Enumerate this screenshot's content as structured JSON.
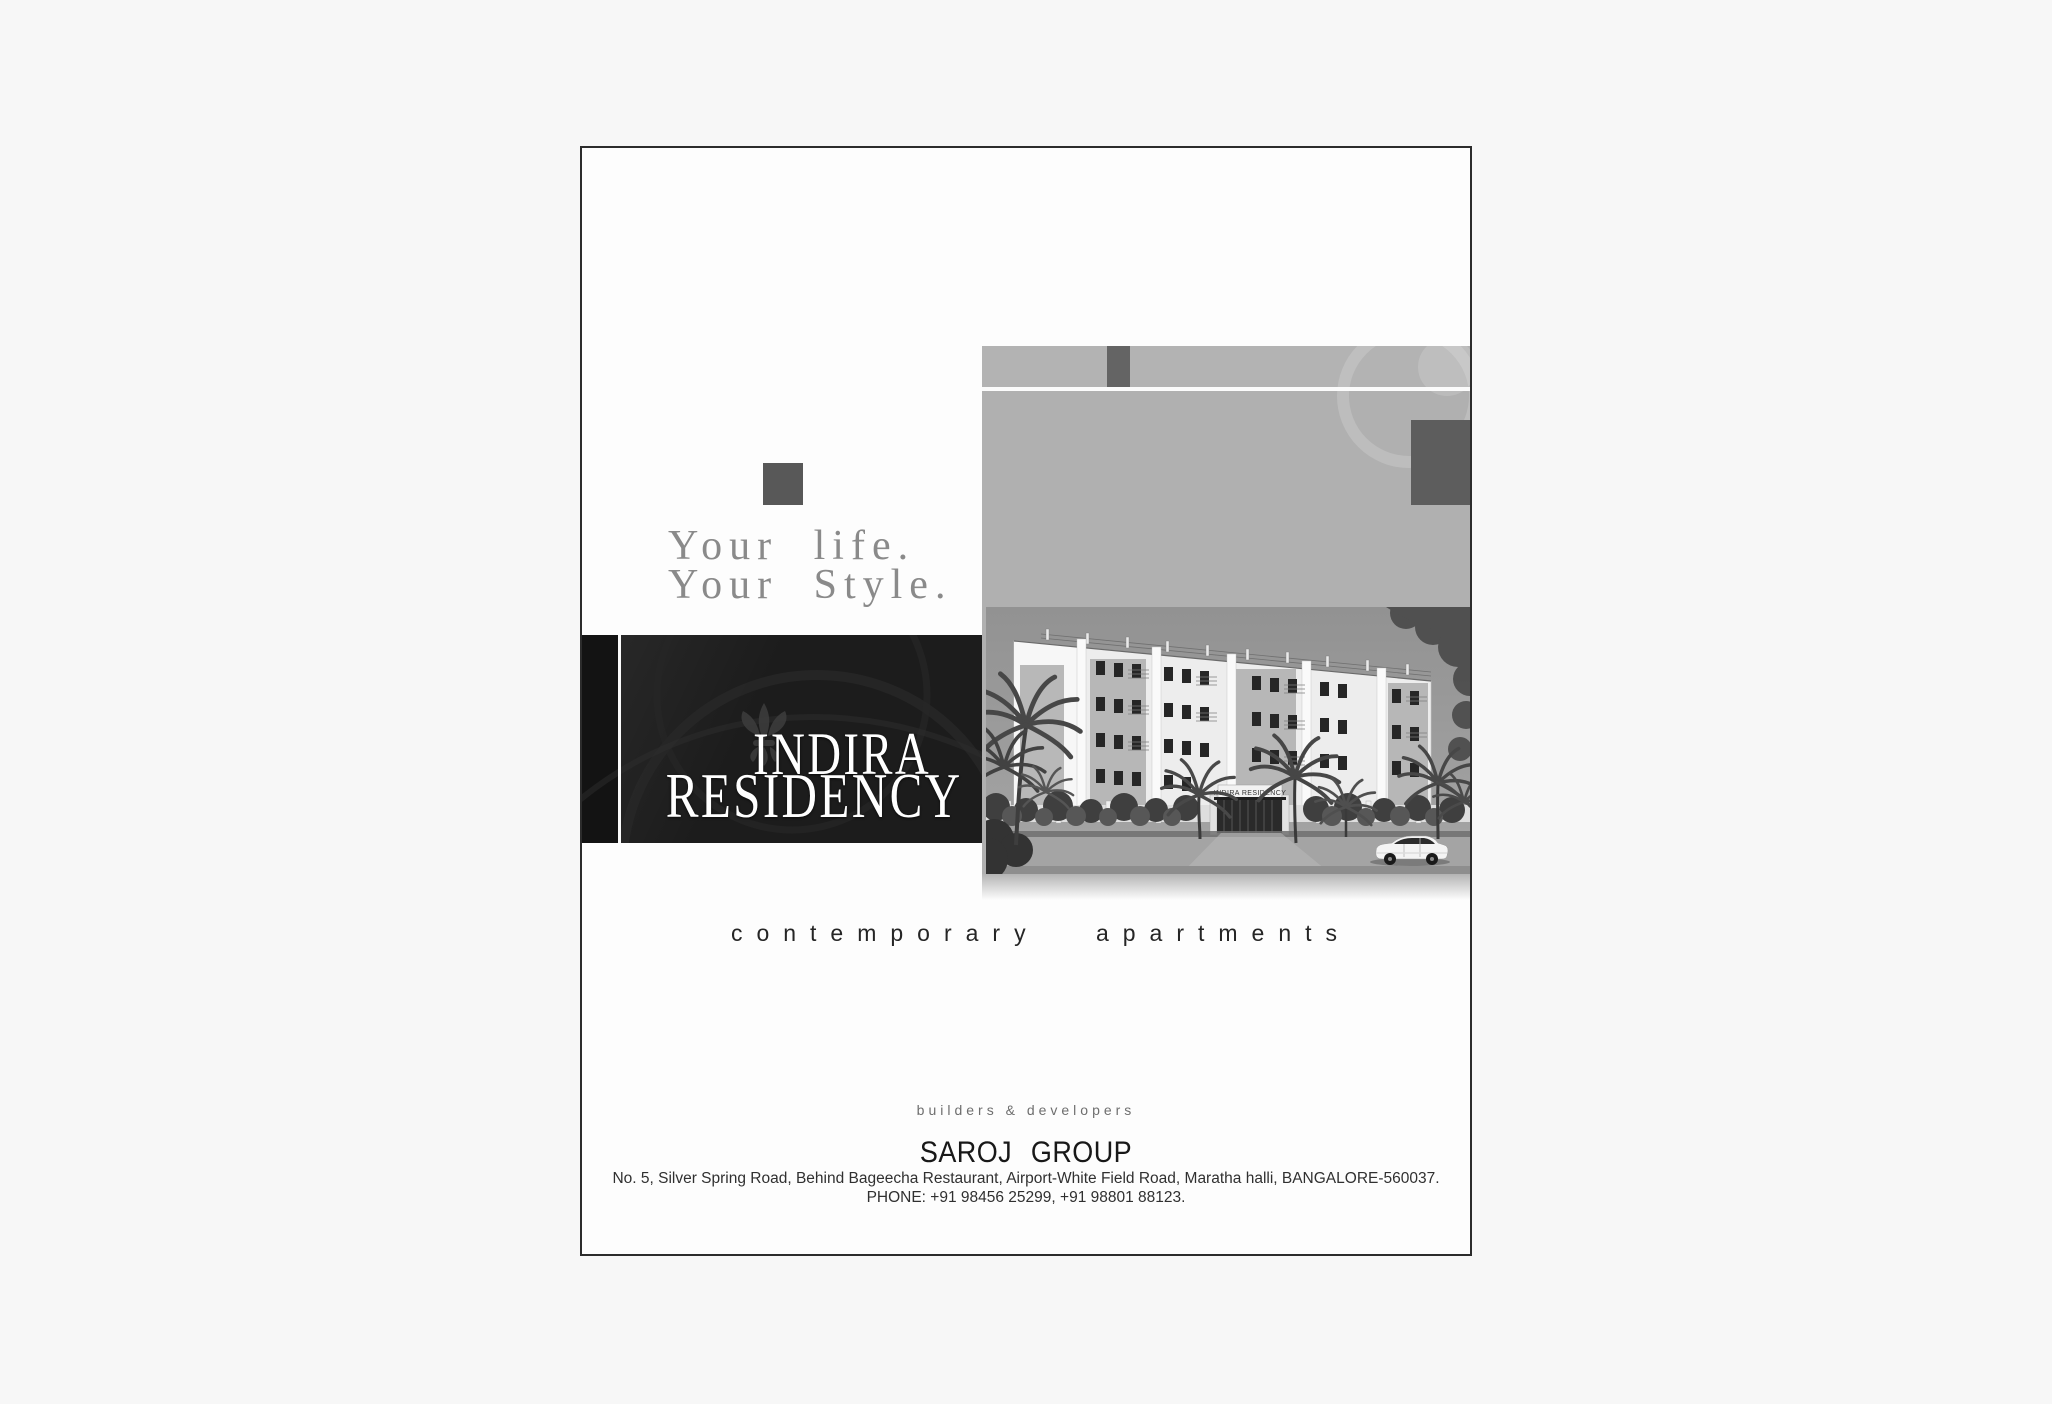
{
  "document": {
    "tagline": {
      "line1": "Your life.",
      "line2": "Your Style."
    },
    "project": {
      "name_line1": "INDIRA",
      "name_line2": "RESIDENCY"
    },
    "subtitle": "contemporary apartments",
    "photo": {
      "building_sign": "INDIRA RESIDENCY"
    },
    "footer": {
      "descriptor": "builders & developers",
      "company_name": "SAROJ GROUP",
      "address_line": "No. 5, Silver Spring Road, Behind Bageecha Restaurant, Airport-White Field Road, Maratha halli, BANGALORE-560037.",
      "phone_line": "PHONE: +91 98456 25299, +91 98801 88123."
    },
    "colors": {
      "banner_background": "#1c1c1c",
      "photo_background": "#b0b0b0",
      "accent_square": "#5d5d5d",
      "page_background": "#fdfdfd"
    }
  }
}
